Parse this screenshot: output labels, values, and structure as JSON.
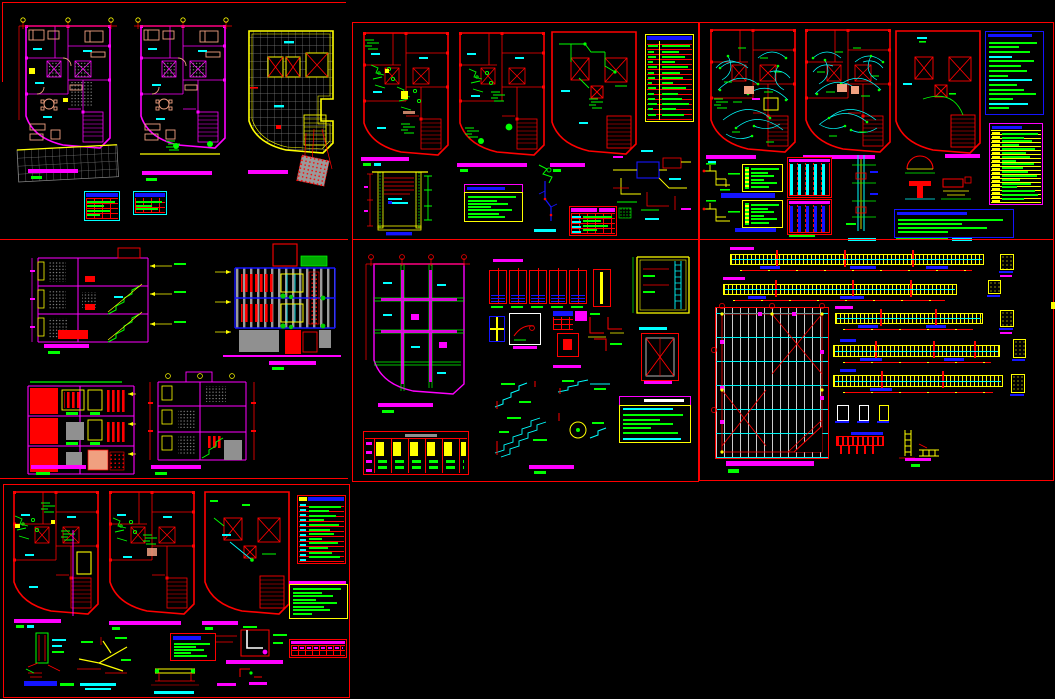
{
  "window": {
    "width": 1055,
    "height": 699,
    "background": "#000000",
    "kind": "cad-multi-sheet-layout"
  },
  "palette": {
    "red": "#FF0000",
    "mag": "#FF00FF",
    "grn": "#00FF00",
    "cyn": "#00FFFF",
    "yel": "#FFFF00",
    "blu": "#1414FF",
    "wht": "#FFFFFF",
    "gry": "#909090",
    "dgry": "#6E6E6E",
    "tan": "#F0A080",
    "blk": "#000000"
  },
  "note": "All lettering in the drawing is below legibility threshold at this resolution; text is rendered as colored annotation bars, matching the screenshot.",
  "sheets": [
    {
      "id": "a",
      "name": "architectural-floor-plans-sheet",
      "components": [
        "first-floor-plan",
        "second-floor-plan",
        "roof-plan",
        "terrace-tile-grid",
        "tilted-concrete-pad",
        "finish-schedule-table-1",
        "finish-schedule-table-2",
        "plan-title-bars"
      ]
    },
    {
      "id": "b",
      "name": "sanitary-water-installation-sheet",
      "components": [
        "water-plan-level-1",
        "water-plan-level-2",
        "water-plan-roof",
        "fixtures-table",
        "cistern-section-detail",
        "legend-box",
        "isometric-riser-detail",
        "connection-table",
        "tank-piping-detail",
        "plan-title-bars"
      ]
    },
    {
      "id": "c",
      "name": "electrical-installation-sheet",
      "components": [
        "electrical-plan-level-1",
        "electrical-plan-level-2",
        "electrical-plan-roof",
        "symbols-legend",
        "circuits-load-table",
        "panelboard-diagram-1",
        "panelboard-diagram-2",
        "feeder-tables",
        "service-riser-detail",
        "duct-arc-detail",
        "tee-beam-detail",
        "notes-box",
        "plan-title-bars"
      ]
    },
    {
      "id": "d",
      "name": "sections-and-elevations-sheet",
      "components": [
        "building-section-1",
        "main-elevation",
        "rear-elevation",
        "building-section-2",
        "title-bars"
      ]
    },
    {
      "id": "e",
      "name": "foundation-and-structural-details-sheet",
      "components": [
        "foundation-plan",
        "footing-details-row",
        "column-section-details",
        "cistern-structure-detail",
        "crossed-slab-detail",
        "stair-reinforcement-details",
        "specifications-box",
        "column-schedule-table"
      ]
    },
    {
      "id": "f",
      "name": "beams-and-slab-framing-sheet",
      "components": [
        "beam-elevation-1",
        "beam-elevation-2",
        "beam-elevation-3",
        "beam-elevation-4",
        "beam-elevation-5",
        "beam-cross-sections",
        "slab-framing-plan",
        "base-plate-details",
        "joist-details",
        "title-bar"
      ]
    },
    {
      "id": "g",
      "name": "drainage-gas-installation-sheet",
      "components": [
        "drain-plan-level-1",
        "drain-plan-level-2",
        "drain-plan-roof",
        "symbols-legend-table",
        "notes-box",
        "vent-stack-detail",
        "branch-fitting-detail",
        "small-notes-box",
        "trench-detail",
        "wall-sleeve-detail",
        "schedule-strip-table",
        "plan-title-bars"
      ]
    }
  ]
}
